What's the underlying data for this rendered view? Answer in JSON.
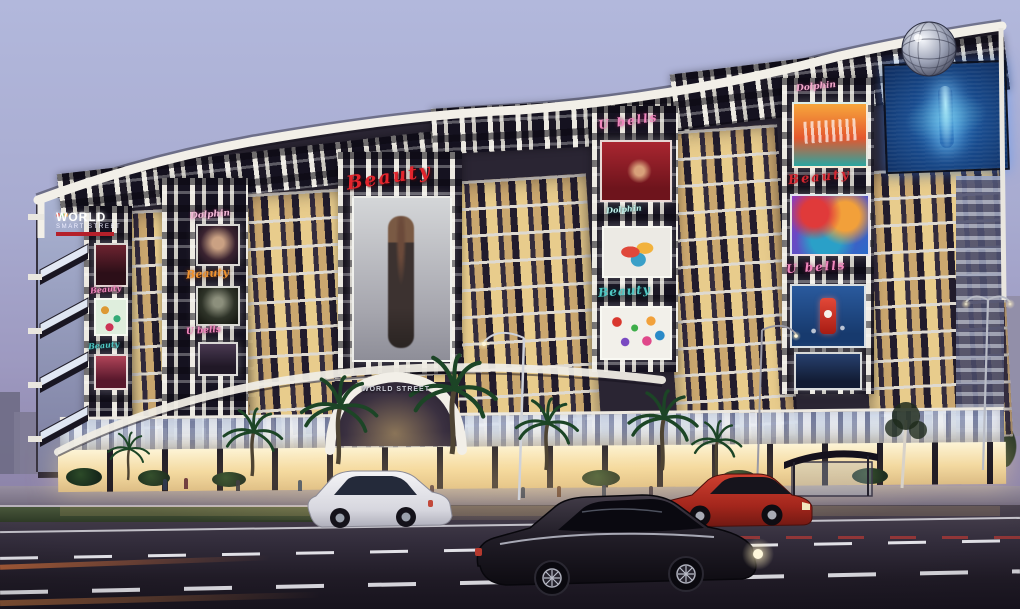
{
  "signs": {
    "main_line1": "WORLD",
    "main_line2": "SMART STREET",
    "arch": "WORLD STREET",
    "beauty": "Beauty",
    "ubells": "U bells",
    "dolphin": "Dolphin"
  },
  "billboards": [
    "fashion-model-large",
    "portrait-woman",
    "dark-model",
    "green-confetti",
    "pink-fashion",
    "red-fashion",
    "sneakers",
    "confetti",
    "music-festival",
    "abstract-art",
    "beverage-can",
    "led-dancer-screen"
  ],
  "colors": {
    "sky_top": "#b2b8dc",
    "sky_horizon": "#8f86ac",
    "facade_dark": "#2a2533",
    "roof_white": "#f2efe8",
    "window_warm": "#f6d98f",
    "beauty_red": "#e2242c",
    "beauty_orange": "#f0922e",
    "beauty_teal": "#4ec6c2",
    "ubells_pink": "#ef86bc",
    "screen_blue": "#1d5c9e",
    "car_red": "#b3271f",
    "car_white": "#eceaee",
    "car_black": "#16131b"
  }
}
